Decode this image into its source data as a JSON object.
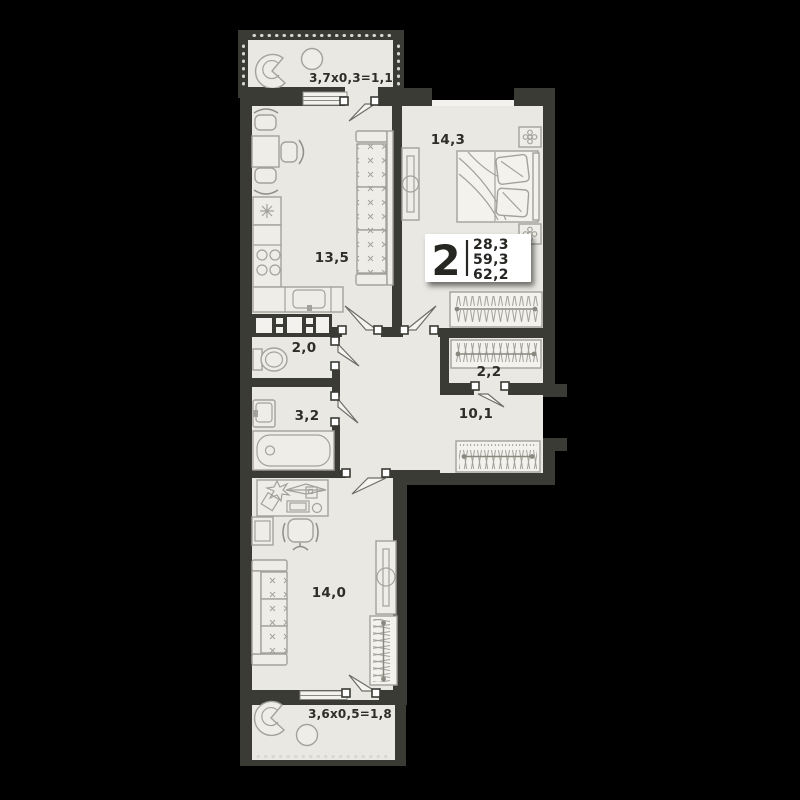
{
  "floor_plan": {
    "card": {
      "rooms_count": "2",
      "areas": {
        "living": "28,3",
        "apartment": "59,3",
        "total": "62,2"
      }
    },
    "labels": {
      "balcony_top": "3,7x0,3=1,1",
      "kitchen_living": "13,5",
      "bedroom": "14,3",
      "wc": "2,0",
      "closet": "2,2",
      "bathroom": "3,2",
      "hallway": "10,1",
      "room": "14,0",
      "balcony_bottom": "3,6x0,5=1,8"
    },
    "colors": {
      "background": "#000000",
      "wall": "#3b3b35",
      "floor": "#e9e8e2",
      "furniture_line": "#a3a29a",
      "label_text": "#2d2d29",
      "card_bg": "#ffffff"
    }
  }
}
